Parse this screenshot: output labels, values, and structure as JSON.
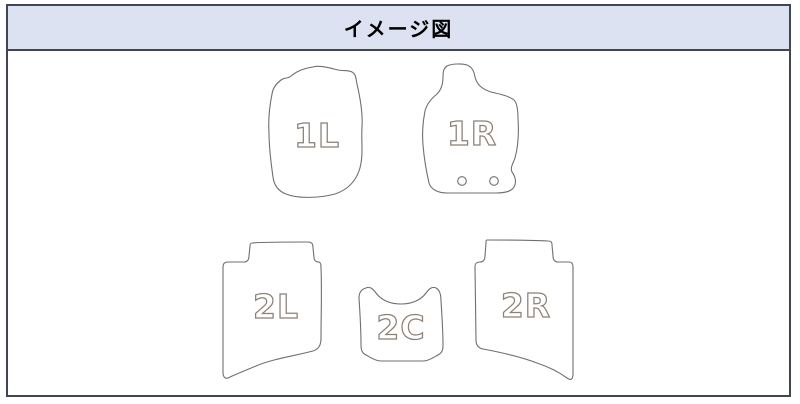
{
  "header": {
    "title": "イメージ図"
  },
  "diagram": {
    "description_label": "floor-mat-set-layout",
    "mats": [
      {
        "id": "front-left",
        "label": "1L"
      },
      {
        "id": "front-right",
        "label": "1R",
        "grommet_holes": 2
      },
      {
        "id": "rear-left",
        "label": "2L"
      },
      {
        "id": "rear-center",
        "label": "2C"
      },
      {
        "id": "rear-right",
        "label": "2R"
      }
    ]
  },
  "colors": {
    "frame_border": "#42464f",
    "header_background": "#dce2f2",
    "title_text": "#000000",
    "mat_outline": "#6f6f6f",
    "mat_fill": "#ffffff",
    "label_outline": "#8c8177",
    "label_fill": "#ffffff"
  }
}
